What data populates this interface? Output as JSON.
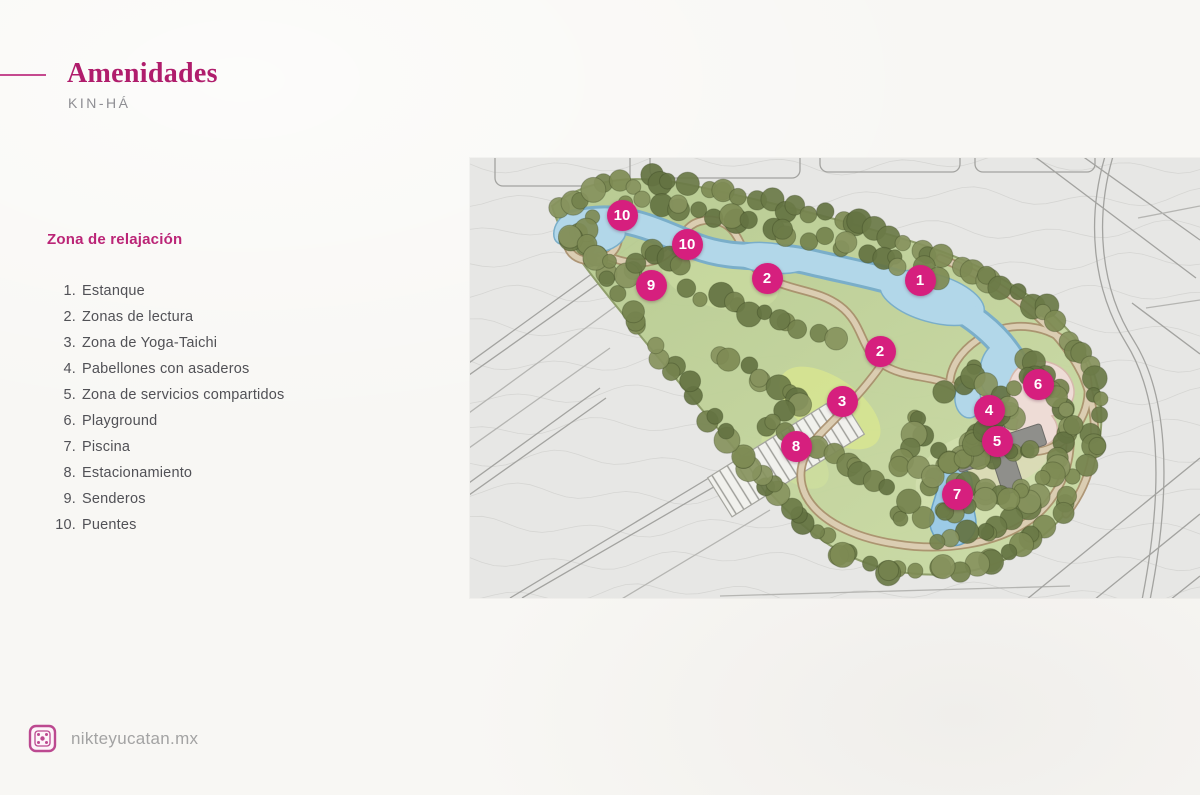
{
  "header": {
    "title": "Amenidades",
    "subtitle": "KIN-HÁ"
  },
  "section": {
    "heading": "Zona de relajación"
  },
  "amenities": [
    {
      "num": "1.",
      "label": "Estanque"
    },
    {
      "num": "2.",
      "label": "Zonas de lectura"
    },
    {
      "num": "3.",
      "label": "Zona de Yoga-Taichi"
    },
    {
      "num": "4.",
      "label": "Pabellones con asaderos"
    },
    {
      "num": "5.",
      "label": "Zona de servicios compartidos"
    },
    {
      "num": "6.",
      "label": "Playground"
    },
    {
      "num": "7.",
      "label": "Piscina"
    },
    {
      "num": "8.",
      "label": "Estacionamiento"
    },
    {
      "num": "9.",
      "label": "Senderos"
    },
    {
      "num": "10.",
      "label": "Puentes"
    }
  ],
  "map": {
    "markers": [
      {
        "num": "10",
        "x": 152,
        "y": 57
      },
      {
        "num": "10",
        "x": 217,
        "y": 86
      },
      {
        "num": "9",
        "x": 181,
        "y": 127
      },
      {
        "num": "2",
        "x": 297,
        "y": 120
      },
      {
        "num": "1",
        "x": 450,
        "y": 122
      },
      {
        "num": "2",
        "x": 410,
        "y": 193
      },
      {
        "num": "3",
        "x": 372,
        "y": 243
      },
      {
        "num": "6",
        "x": 568,
        "y": 226
      },
      {
        "num": "4",
        "x": 519,
        "y": 252
      },
      {
        "num": "5",
        "x": 527,
        "y": 283
      },
      {
        "num": "8",
        "x": 326,
        "y": 288
      },
      {
        "num": "7",
        "x": 487,
        "y": 336
      }
    ]
  },
  "footer": {
    "site": "nikteyucatan.mx"
  },
  "colors": {
    "accent_pink": "#d61f7e",
    "title_pink": "#b01d6c",
    "heading_pink": "#bb2577",
    "body_text": "#515156",
    "subtitle_gray": "#8e8e93",
    "footer_gray": "#a3a3a3",
    "park_green": "#c0d29c",
    "water_blue": "#b2d7e9"
  }
}
